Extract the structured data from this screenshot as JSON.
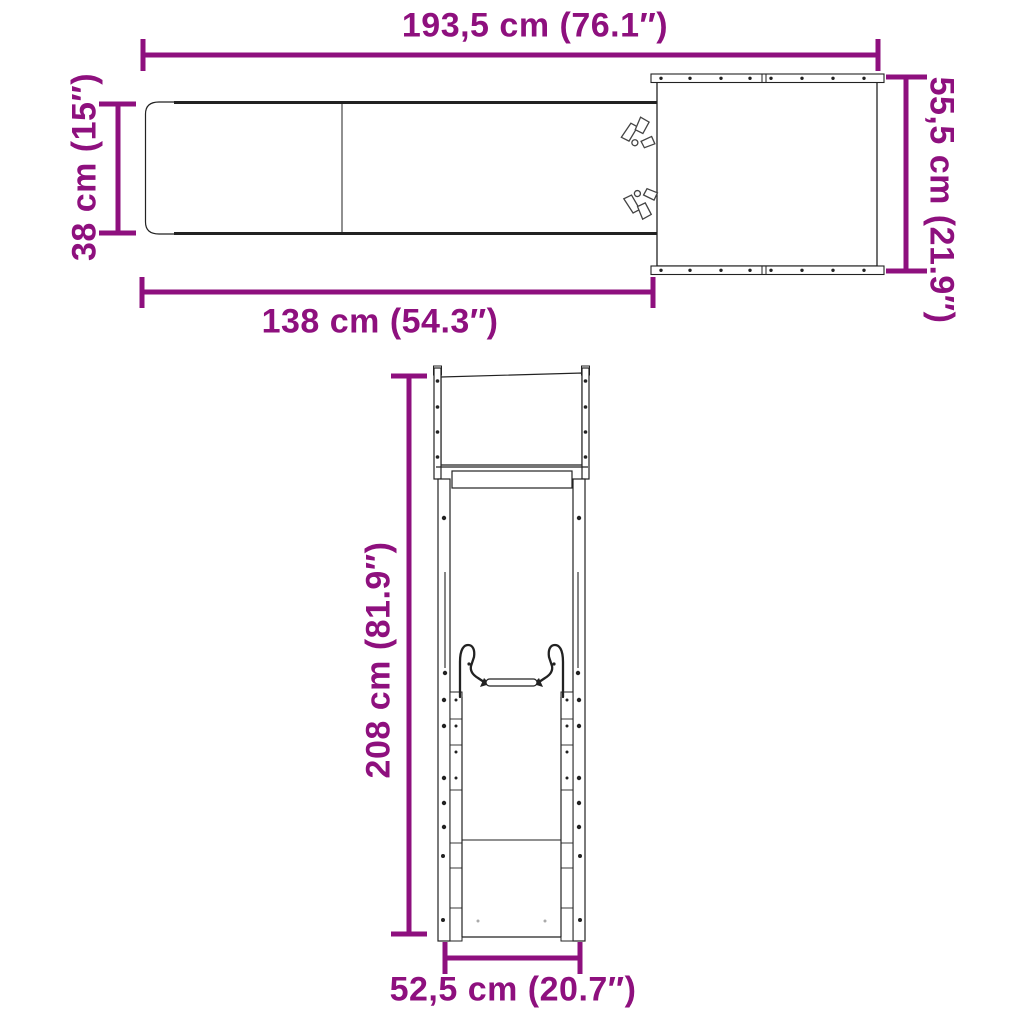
{
  "colors": {
    "accent": "#8E107E",
    "line": "#222222",
    "background": "#FFFFFF"
  },
  "top_view": {
    "dims": {
      "overall_length": "193,5 cm (76.1″)",
      "slide_width": "38 cm (15″)",
      "platform_depth": "55,5 cm (21.9″)",
      "slide_length": "138 cm (54.3″)"
    }
  },
  "front_view": {
    "dims": {
      "overall_height": "208 cm (81.9″)",
      "frame_width": "52,5 cm (20.7″)"
    }
  }
}
